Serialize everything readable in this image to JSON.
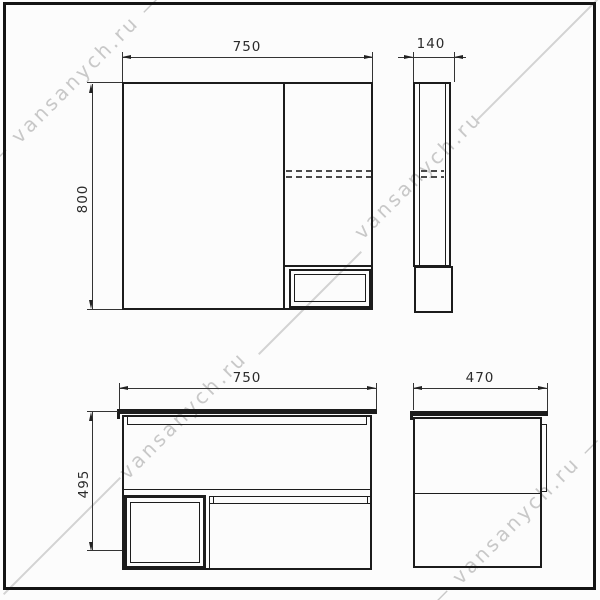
{
  "watermark": {
    "text": "vansanych.ru",
    "text_with_dashes": "— vansanych.ru —"
  },
  "views": {
    "mirror_front": {
      "label_width": "750",
      "label_height": "800"
    },
    "mirror_side": {
      "label_depth": "140"
    },
    "vanity_front": {
      "label_width": "750",
      "label_height": "495"
    },
    "vanity_side": {
      "label_depth": "470"
    }
  },
  "colors": {
    "line": "#1c1c1c",
    "dimension": "#2b2b2b",
    "shelf_dashed": "#4a4a4a",
    "watermark": "#c8c8c8",
    "background": "#fcfcfc"
  }
}
